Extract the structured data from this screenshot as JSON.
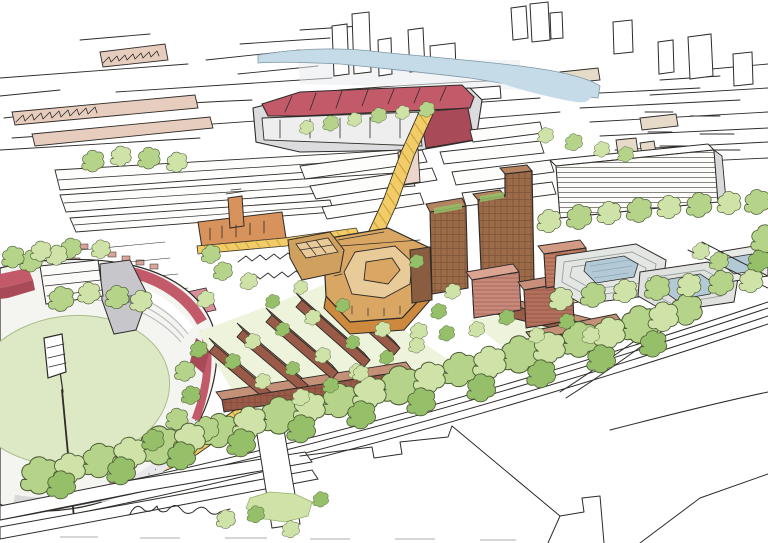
{
  "meta": {
    "title": "Hand-drawn aerial masterplan sketch",
    "description": "Watercolour-and-ink aerial perspective of an urban masterplan: a cricket stadium with pale green pitch and red stands at lower left, a red-roofed football stadium in the upper distance, a yellow processional route linking them, a cluster of new brown and terracotta buildings with towers and tree-lined courtyards in the centre, grey stepped office buildings to the right, a railway corridor with a dense tree belt across the foreground, and a loose pen-sketched city skyline with a pale blue canal beyond."
  },
  "palette": {
    "paper": "#ffffff",
    "ink": "#2e2b28",
    "water": "#c6dbe8",
    "wash_grey": "#e9ebee",
    "pitch_green": "#dde8c4",
    "pitch_edge": "#aebd8a",
    "stand_red": "#c25a6a",
    "stand_red_dark": "#a84a58",
    "stand_red_light": "#d98f9b",
    "roof_grey": "#c7c7cb",
    "concourse_grey": "#e9e9ec",
    "road_yellow": "#f2cc66",
    "paving_line": "#bf9433",
    "tree_light": "#cfe3a8",
    "tree_mid": "#b5d489",
    "tree_dark": "#95bf68",
    "wash_green": "#eef3dc",
    "brick_dark": "#9a5a48",
    "brick_roof": "#c49078",
    "terracotta_pink1": "#c9897a",
    "terracotta_pink2": "#b3705c",
    "terracotta_pink3": "#c07b62",
    "tan_body": "#d9a763",
    "tan_light": "#e9cb9a",
    "tan_base": "#cd8a3f",
    "tan_ground": "#e9cb8e",
    "tower_brown": "#9c6b49",
    "tower_brown_light": "#b4835f",
    "town_hall_orange": "#d8935c",
    "shed_pink": "#e7cdbd",
    "beige": "#e6dac8",
    "glass_blue": "#b3c9d6",
    "office_grey": "#e3e6e3",
    "house_pink": "#d8a79b"
  },
  "scene": {
    "regions": [
      {
        "name": "background-skyline",
        "label": "loose pen sketch of distant city blocks and towers"
      },
      {
        "name": "canal",
        "label": "pale blue ship canal winding across the top"
      },
      {
        "name": "football-stadium",
        "label": "large stadium with red trussed roof, upper centre"
      },
      {
        "name": "west-industrial",
        "label": "sawtooth-roofed sheds and long warehouses, left"
      },
      {
        "name": "town-hall",
        "label": "orange brick civic building with clock tower"
      },
      {
        "name": "processional-route",
        "label": "yellow paved route running diagonally past the cricket ground"
      },
      {
        "name": "cricket-stadium",
        "label": "cricket ground: pale green oval pitch, red and white stands, floodlight"
      },
      {
        "name": "masterplan-development",
        "label": "new quarter of brown terraces, tan courtyard block, brick towers and green courts"
      },
      {
        "name": "stepped-offices",
        "label": "grey terraced office buildings with blue glass roofs, right"
      },
      {
        "name": "hatched-slab-building",
        "label": "long line-hatched office slab, upper right"
      },
      {
        "name": "railway-corridor",
        "label": "diagonal railway lines with dense tree belt"
      },
      {
        "name": "foreground-parcels",
        "label": "white outlined land parcels and roads, bottom"
      }
    ]
  }
}
